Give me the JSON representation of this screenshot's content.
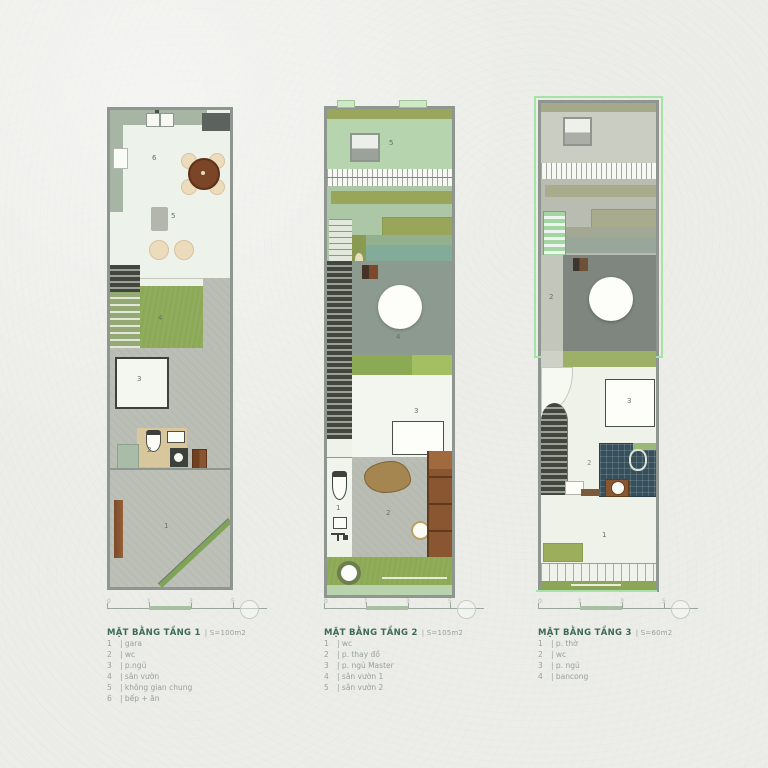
{
  "plans": [
    {
      "title": "MẶT BẰNG TẦNG 1",
      "area": "| S=100m2",
      "marks": {
        "m1": "1",
        "m2": "2",
        "m3": "3",
        "m4": "4",
        "m5": "5",
        "m6": "6"
      },
      "legend": [
        {
          "num": "1",
          "label": "| gara"
        },
        {
          "num": "2",
          "label": "| wc"
        },
        {
          "num": "3",
          "label": "| p.ngủ"
        },
        {
          "num": "4",
          "label": "| sân vườn"
        },
        {
          "num": "5",
          "label": "| không gian chung"
        },
        {
          "num": "6",
          "label": "| bếp + ăn"
        }
      ]
    },
    {
      "title": "MẶT BẰNG TẦNG 2",
      "area": "| S=105m2",
      "marks": {
        "m1": "1",
        "m2": "2",
        "m3": "3",
        "m4": "4",
        "m5": "5"
      },
      "legend": [
        {
          "num": "1",
          "label": "| wc"
        },
        {
          "num": "2",
          "label": "| p. thay đồ"
        },
        {
          "num": "3",
          "label": "| p. ngủ Master"
        },
        {
          "num": "4",
          "label": "| sân vườn 1"
        },
        {
          "num": "5",
          "label": "| sân vườn 2"
        }
      ]
    },
    {
      "title": "MẶT BẰNG TẦNG 3",
      "area": "| S=60m2",
      "marks": {
        "m1": "1",
        "m2": "2",
        "m3": "3",
        "mvoid": "2"
      },
      "legend": [
        {
          "num": "1",
          "label": "| p. thờ"
        },
        {
          "num": "2",
          "label": "| wc"
        },
        {
          "num": "3",
          "label": "| p. ngủ"
        },
        {
          "num": "4",
          "label": "| bancong"
        }
      ]
    }
  ],
  "scalebar": {
    "labels": [
      "0",
      "1",
      "3",
      "5"
    ]
  },
  "colors": {
    "wall_gray": "#8f968f",
    "grass_green": "#8ca953",
    "roof_green": "#b6d4ad",
    "frame_green": "#a6e3a6",
    "title_green": "#3c6a52",
    "wood_brown": "#8a5632",
    "tile_blue": "#35505c"
  }
}
